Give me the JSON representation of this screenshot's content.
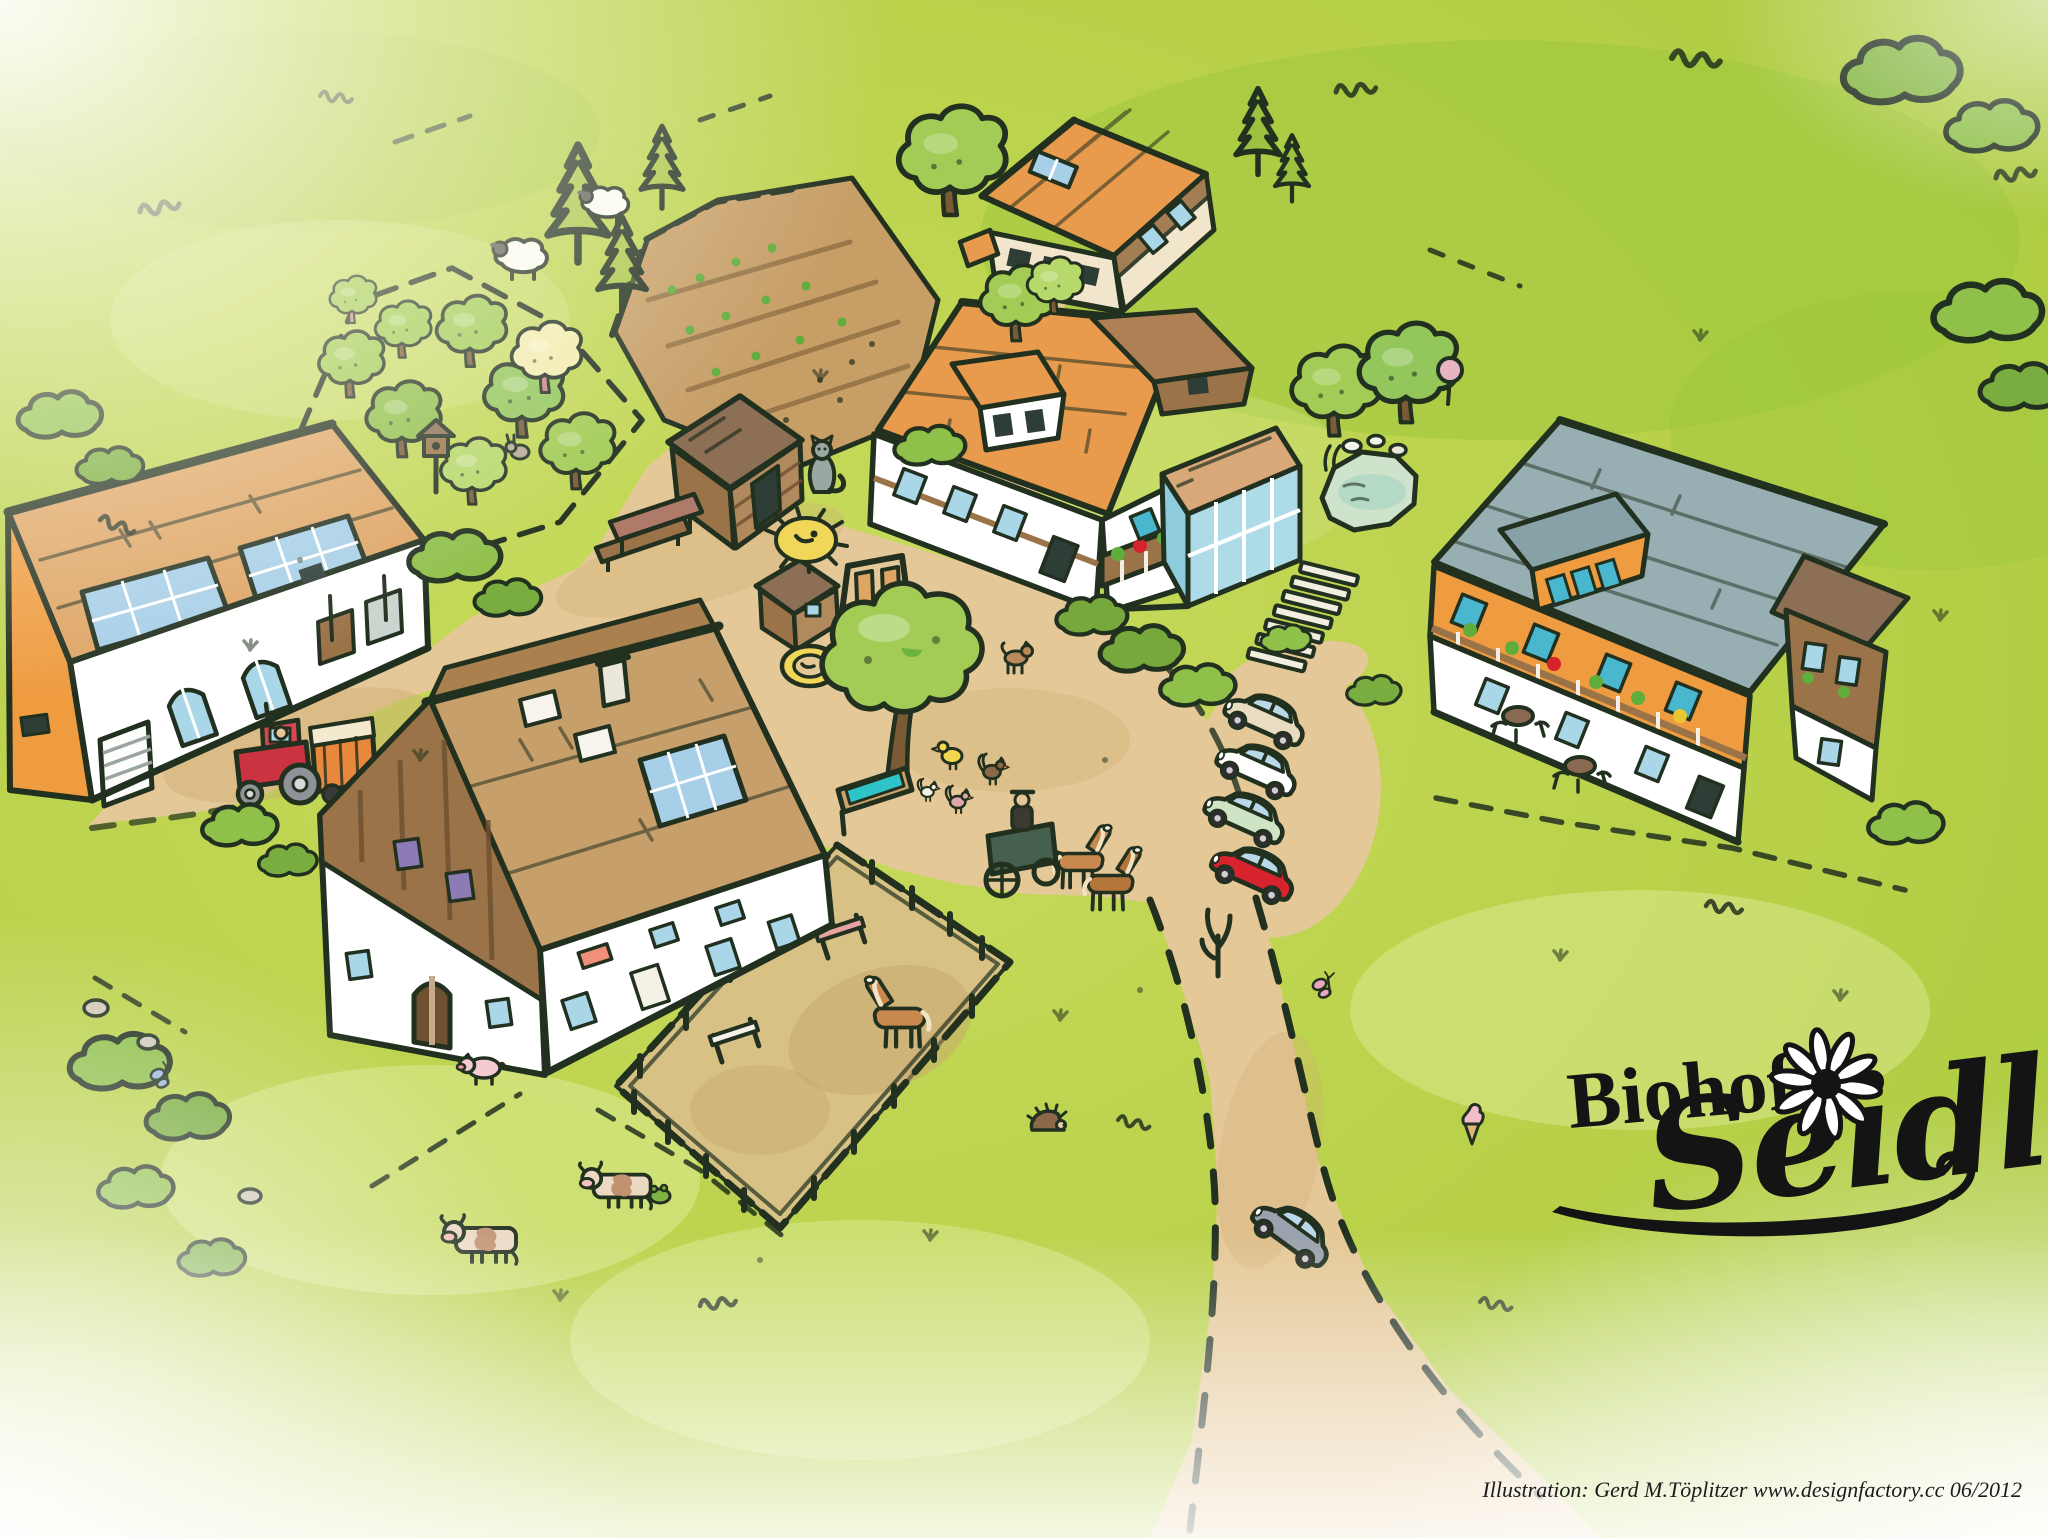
{
  "scene": {
    "type": "illustrated-farm-map",
    "farm_name": "Biohof Seidl",
    "logo": {
      "prefix": "Biohof",
      "script_name": "Seidl",
      "flower_icon": "daisy"
    },
    "credit": "Illustration: Gerd M.Töplitzer  www.designfactory.cc  06/2012",
    "colors": {
      "outline": "#22301f",
      "grass": "#bcd34c",
      "grass_light": "#dce994",
      "grass_dark": "#9cc53b",
      "sand": "#e5c897",
      "sand_dark": "#cfae74",
      "soil": "#c79e66",
      "soil_row": "#8a6a3e",
      "roof_orange": "#e89a4d",
      "roof_tan": "#dfa565",
      "roof_brown": "#c79f6b",
      "roof_brown_dark": "#a9804e",
      "roof_taupe": "#8c6f54",
      "roof_gray": "#97aeb2",
      "roof_gray_dark": "#87a2a6",
      "wall_white": "#ffffff",
      "wall_cream": "#f1e5cb",
      "wall_orange": "#ef9c41",
      "timber": "#9b7348",
      "timber_dark": "#6f5132",
      "window_blue": "#a9d7e8",
      "window_teal": "#49b8cf",
      "window_dark": "#2e3d36",
      "solar": "#a7cfe8",
      "purple": "#8d7bb5",
      "salmon": "#f0907a",
      "tree_green": "#a2cc55",
      "tree_green_dark": "#76a83c",
      "tree_yellow": "#f3ecb0",
      "pond_green": "#cfe3cc",
      "water_teal": "#2ec4c9",
      "car_red": "#d6232e",
      "car_green": "#cfe4c4",
      "car_beige": "#e9dcc0",
      "car_white": "#ffffff",
      "car_gray": "#9aa3ad",
      "tractor_red": "#cc3340",
      "wagon_orange": "#e8883c",
      "horse_brown": "#c9894e",
      "pig_pink": "#f5cad1",
      "logo_black": "#141414"
    }
  }
}
